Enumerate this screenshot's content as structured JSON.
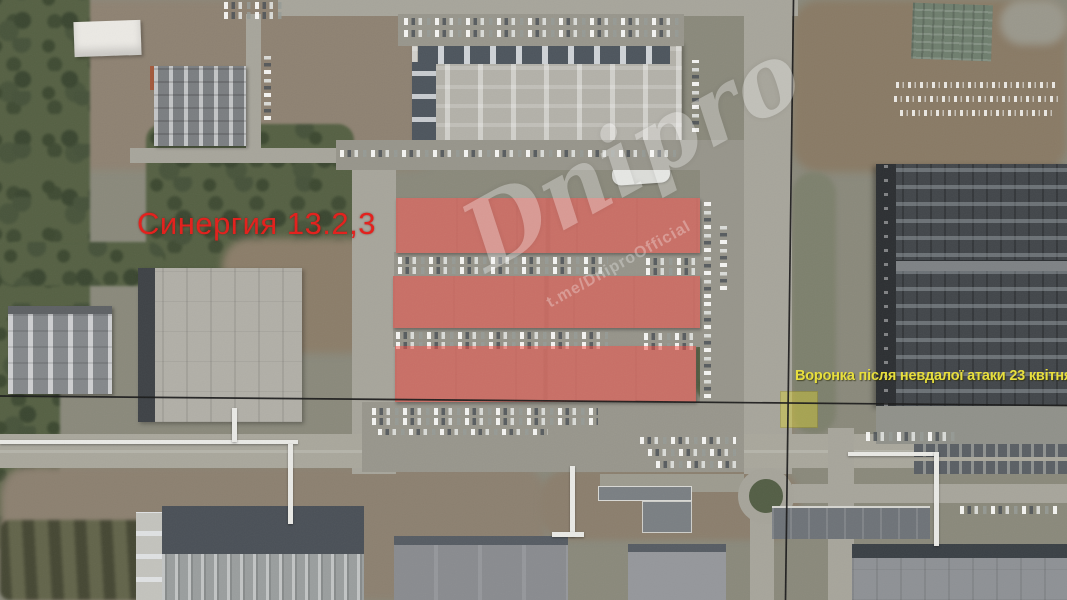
{
  "annotations": {
    "facility_label": {
      "text": "Синергия 13.2,3",
      "color": "#e41e1a"
    },
    "crater_label": {
      "text": "Воронка після невдалої атаки 23 квітня",
      "color": "#e9e03a"
    },
    "highlight": {
      "buildings_color": "#f4493f",
      "crater_box_color": "#d9cf32",
      "crosshair_color": "#1a1a1a"
    },
    "watermark": {
      "title": "Dnipro",
      "handle": "t.me/DniproOfficial",
      "color": "#ffffff"
    }
  }
}
